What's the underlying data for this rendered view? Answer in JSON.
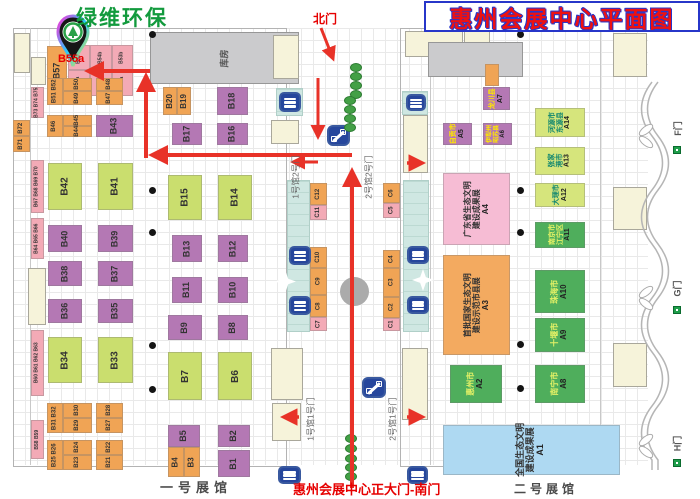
{
  "title": "惠州会展中心平面图",
  "brand": {
    "name": "绿维环保",
    "pin_label": "B55a"
  },
  "labels": {
    "north_gate": "北门",
    "south_gate": "惠州会展中心正大门-南门",
    "hall1": "一号展馆",
    "hall2": "二号展馆",
    "storage": "库房",
    "gate_f": "F门",
    "gate_g": "G门",
    "gate_h": "H门",
    "h1g2": "1号馆2号门",
    "h2g2": "2号馆2号门",
    "h1g1": "1号馆1号门",
    "h2g1": "2号馆1号门"
  },
  "colors": {
    "purple": "#b478b4",
    "lime": "#cade6e",
    "orange": "#f0a455",
    "pink": "#f3aab6",
    "pinkBig": "#f6bcd4",
    "orangeBig": "#f3aa60",
    "blue": "#aed9f2",
    "green": "#4fae5c",
    "lime2": "#d6e57c",
    "arrow": "#e83228",
    "titleRed": "#ee1111",
    "titleBlue": "#2736c9"
  },
  "booths": [
    {
      "n": "B73 B74 B75",
      "x": 31,
      "y": 87,
      "w": 13,
      "h": 31,
      "c": "pink",
      "fs": 5
    },
    {
      "n": "B67 B68 B69 B70",
      "x": 31,
      "y": 160,
      "w": 13,
      "h": 53,
      "c": "pink",
      "fs": 5
    },
    {
      "n": "B64 B65 B66",
      "x": 31,
      "y": 218,
      "w": 13,
      "h": 41,
      "c": "pink",
      "fs": 5
    },
    {
      "n": "B60 B61 B62 B63",
      "x": 31,
      "y": 330,
      "w": 13,
      "h": 66,
      "c": "pink",
      "fs": 5
    },
    {
      "n": "B58 B59",
      "x": 31,
      "y": 420,
      "w": 13,
      "h": 39,
      "c": "pink",
      "fs": 5
    },
    {
      "n": "B72",
      "x": 13,
      "y": 120,
      "w": 17,
      "h": 16,
      "c": "orange",
      "fs": 6
    },
    {
      "n": "B71",
      "x": 13,
      "y": 136,
      "w": 17,
      "h": 16,
      "c": "orange",
      "fs": 6
    },
    {
      "n": "B57",
      "x": 47,
      "y": 46,
      "w": 20,
      "h": 49,
      "c": "orange",
      "fs": 9
    },
    {
      "n": "B55b",
      "x": 68,
      "y": 45,
      "w": 22,
      "h": 25,
      "c": "pink",
      "fs": 5
    },
    {
      "n": "B55a",
      "x": 68,
      "y": 70,
      "w": 22,
      "h": 26,
      "c": "pink",
      "fs": 5
    },
    {
      "n": "B54b",
      "x": 90,
      "y": 45,
      "w": 22,
      "h": 25,
      "c": "pink",
      "fs": 5
    },
    {
      "n": "B54a",
      "x": 90,
      "y": 70,
      "w": 22,
      "h": 26,
      "c": "pink",
      "fs": 5
    },
    {
      "n": "B53b",
      "x": 112,
      "y": 45,
      "w": 21,
      "h": 25,
      "c": "pink",
      "fs": 5
    },
    {
      "n": "B53a",
      "x": 112,
      "y": 70,
      "w": 21,
      "h": 26,
      "c": "pink",
      "fs": 5
    },
    {
      "n": "B51 B52",
      "x": 47,
      "y": 78,
      "w": 16,
      "h": 27,
      "c": "orange",
      "fs": 6
    },
    {
      "n": "B50",
      "x": 63,
      "y": 78,
      "w": 29,
      "h": 13,
      "c": "orange",
      "fs": 6
    },
    {
      "n": "B49",
      "x": 63,
      "y": 91,
      "w": 29,
      "h": 14,
      "c": "orange",
      "fs": 6
    },
    {
      "n": "B48",
      "x": 96,
      "y": 78,
      "w": 27,
      "h": 13,
      "c": "orange",
      "fs": 6
    },
    {
      "n": "B47",
      "x": 96,
      "y": 91,
      "w": 27,
      "h": 14,
      "c": "orange",
      "fs": 6
    },
    {
      "n": "B46",
      "x": 47,
      "y": 115,
      "w": 16,
      "h": 22,
      "c": "orange",
      "fs": 6
    },
    {
      "n": "B45",
      "x": 63,
      "y": 115,
      "w": 29,
      "h": 11,
      "c": "orange",
      "fs": 6
    },
    {
      "n": "B44",
      "x": 63,
      "y": 126,
      "w": 29,
      "h": 11,
      "c": "orange",
      "fs": 6
    },
    {
      "n": "B43",
      "x": 96,
      "y": 115,
      "w": 37,
      "h": 22,
      "c": "purple",
      "fs": 9
    },
    {
      "n": "B42",
      "x": 48,
      "y": 163,
      "w": 34,
      "h": 47,
      "c": "lime",
      "fs": 10
    },
    {
      "n": "B41",
      "x": 98,
      "y": 163,
      "w": 35,
      "h": 47,
      "c": "lime",
      "fs": 10
    },
    {
      "n": "B40",
      "x": 48,
      "y": 225,
      "w": 34,
      "h": 27,
      "c": "purple",
      "fs": 9
    },
    {
      "n": "B39",
      "x": 98,
      "y": 225,
      "w": 35,
      "h": 27,
      "c": "purple",
      "fs": 9
    },
    {
      "n": "B38",
      "x": 48,
      "y": 261,
      "w": 34,
      "h": 25,
      "c": "purple",
      "fs": 9
    },
    {
      "n": "B37",
      "x": 98,
      "y": 261,
      "w": 35,
      "h": 25,
      "c": "purple",
      "fs": 9
    },
    {
      "n": "B36",
      "x": 48,
      "y": 299,
      "w": 34,
      "h": 24,
      "c": "purple",
      "fs": 9
    },
    {
      "n": "B35",
      "x": 98,
      "y": 299,
      "w": 35,
      "h": 24,
      "c": "purple",
      "fs": 9
    },
    {
      "n": "B34",
      "x": 48,
      "y": 337,
      "w": 34,
      "h": 46,
      "c": "lime",
      "fs": 10
    },
    {
      "n": "B33",
      "x": 98,
      "y": 337,
      "w": 35,
      "h": 46,
      "c": "lime",
      "fs": 10
    },
    {
      "n": "B31 B32",
      "x": 47,
      "y": 403,
      "w": 16,
      "h": 30,
      "c": "orange",
      "fs": 6
    },
    {
      "n": "B30",
      "x": 63,
      "y": 403,
      "w": 29,
      "h": 15,
      "c": "orange",
      "fs": 6
    },
    {
      "n": "B29",
      "x": 63,
      "y": 418,
      "w": 29,
      "h": 15,
      "c": "orange",
      "fs": 6
    },
    {
      "n": "B28",
      "x": 96,
      "y": 403,
      "w": 27,
      "h": 15,
      "c": "orange",
      "fs": 6
    },
    {
      "n": "B27",
      "x": 96,
      "y": 418,
      "w": 27,
      "h": 15,
      "c": "orange",
      "fs": 6
    },
    {
      "n": "B25 B26",
      "x": 47,
      "y": 440,
      "w": 16,
      "h": 30,
      "c": "orange",
      "fs": 6
    },
    {
      "n": "B24",
      "x": 63,
      "y": 440,
      "w": 29,
      "h": 15,
      "c": "orange",
      "fs": 6
    },
    {
      "n": "B23",
      "x": 63,
      "y": 455,
      "w": 29,
      "h": 15,
      "c": "orange",
      "fs": 6
    },
    {
      "n": "B22",
      "x": 96,
      "y": 440,
      "w": 27,
      "h": 15,
      "c": "orange",
      "fs": 6
    },
    {
      "n": "B21",
      "x": 96,
      "y": 455,
      "w": 27,
      "h": 15,
      "c": "orange",
      "fs": 6
    },
    {
      "n": "B20",
      "x": 163,
      "y": 87,
      "w": 14,
      "h": 28,
      "c": "orange",
      "fs": 8
    },
    {
      "n": "B19",
      "x": 177,
      "y": 87,
      "w": 14,
      "h": 28,
      "c": "orange",
      "fs": 8
    },
    {
      "n": "B18",
      "x": 217,
      "y": 87,
      "w": 31,
      "h": 28,
      "c": "purple",
      "fs": 9
    },
    {
      "n": "B17",
      "x": 172,
      "y": 123,
      "w": 30,
      "h": 22,
      "c": "purple",
      "fs": 9
    },
    {
      "n": "B16",
      "x": 217,
      "y": 123,
      "w": 31,
      "h": 22,
      "c": "purple",
      "fs": 9
    },
    {
      "n": "B15",
      "x": 168,
      "y": 175,
      "w": 34,
      "h": 45,
      "c": "lime",
      "fs": 10
    },
    {
      "n": "B14",
      "x": 218,
      "y": 175,
      "w": 34,
      "h": 45,
      "c": "lime",
      "fs": 10
    },
    {
      "n": "B13",
      "x": 172,
      "y": 235,
      "w": 30,
      "h": 27,
      "c": "purple",
      "fs": 9
    },
    {
      "n": "B12",
      "x": 218,
      "y": 235,
      "w": 30,
      "h": 27,
      "c": "purple",
      "fs": 9
    },
    {
      "n": "B11",
      "x": 172,
      "y": 277,
      "w": 30,
      "h": 26,
      "c": "purple",
      "fs": 9
    },
    {
      "n": "B10",
      "x": 218,
      "y": 277,
      "w": 30,
      "h": 26,
      "c": "purple",
      "fs": 9
    },
    {
      "n": "B9",
      "x": 168,
      "y": 315,
      "w": 34,
      "h": 25,
      "c": "purple",
      "fs": 9
    },
    {
      "n": "B8",
      "x": 218,
      "y": 315,
      "w": 30,
      "h": 25,
      "c": "purple",
      "fs": 9
    },
    {
      "n": "B7",
      "x": 168,
      "y": 352,
      "w": 34,
      "h": 48,
      "c": "lime",
      "fs": 10
    },
    {
      "n": "B6",
      "x": 218,
      "y": 352,
      "w": 34,
      "h": 48,
      "c": "lime",
      "fs": 10
    },
    {
      "n": "B5",
      "x": 168,
      "y": 425,
      "w": 32,
      "h": 22,
      "c": "purple",
      "fs": 9
    },
    {
      "n": "B2",
      "x": 218,
      "y": 425,
      "w": 32,
      "h": 22,
      "c": "purple",
      "fs": 9
    },
    {
      "n": "B4",
      "x": 168,
      "y": 447,
      "w": 16,
      "h": 30,
      "c": "orange",
      "fs": 8
    },
    {
      "n": "B3",
      "x": 184,
      "y": 447,
      "w": 16,
      "h": 30,
      "c": "orange",
      "fs": 8
    },
    {
      "n": "B1",
      "x": 218,
      "y": 450,
      "w": 32,
      "h": 27,
      "c": "purple",
      "fs": 9
    },
    {
      "n": "C12",
      "x": 310,
      "y": 183,
      "w": 17,
      "h": 22,
      "c": "orange",
      "fs": 6
    },
    {
      "n": "C11",
      "x": 310,
      "y": 205,
      "w": 17,
      "h": 15,
      "c": "pink",
      "fs": 6
    },
    {
      "n": "C10",
      "x": 310,
      "y": 247,
      "w": 17,
      "h": 21,
      "c": "orange",
      "fs": 6
    },
    {
      "n": "C9",
      "x": 310,
      "y": 268,
      "w": 17,
      "h": 27,
      "c": "orange",
      "fs": 6
    },
    {
      "n": "C8",
      "x": 310,
      "y": 295,
      "w": 17,
      "h": 22,
      "c": "orange",
      "fs": 6
    },
    {
      "n": "C7",
      "x": 310,
      "y": 317,
      "w": 17,
      "h": 14,
      "c": "pink",
      "fs": 6
    },
    {
      "n": "C6",
      "x": 383,
      "y": 183,
      "w": 17,
      "h": 20,
      "c": "orange",
      "fs": 6
    },
    {
      "n": "C5",
      "x": 383,
      "y": 203,
      "w": 17,
      "h": 15,
      "c": "pink",
      "fs": 6
    },
    {
      "n": "C4",
      "x": 383,
      "y": 250,
      "w": 17,
      "h": 18,
      "c": "orange",
      "fs": 6
    },
    {
      "n": "C3",
      "x": 383,
      "y": 268,
      "w": 17,
      "h": 29,
      "c": "orange",
      "fs": 6
    },
    {
      "n": "C2",
      "x": 383,
      "y": 297,
      "w": 17,
      "h": 21,
      "c": "orange",
      "fs": 6
    },
    {
      "n": "C1",
      "x": 383,
      "y": 318,
      "w": 17,
      "h": 13,
      "c": "pink",
      "fs": 6
    },
    {
      "n": "龙川县|A7",
      "x": 483,
      "y": 87,
      "w": 27,
      "h": 23,
      "c": "purple",
      "tc": "#ffe800",
      "fs": 7
    },
    {
      "n": "自贡市|A5",
      "x": 443,
      "y": 123,
      "w": 29,
      "h": 22,
      "c": "purple",
      "tc": "#ffe800",
      "fs": 7
    },
    {
      "n": "伊犁州|昭苏县|A6",
      "x": 483,
      "y": 123,
      "w": 29,
      "h": 22,
      "c": "purple",
      "tc": "#ffe800",
      "fs": 6
    },
    {
      "n": "河源市|东源县|A14",
      "x": 535,
      "y": 108,
      "w": 50,
      "h": 29,
      "c": "lime2",
      "tc": "#12876f",
      "fs": 7
    },
    {
      "n": "张家|港市|A13",
      "x": 535,
      "y": 147,
      "w": 50,
      "h": 28,
      "c": "lime2",
      "tc": "#12876f",
      "fs": 7
    },
    {
      "n": "大理市|A12",
      "x": 535,
      "y": 183,
      "w": 50,
      "h": 24,
      "c": "lime2",
      "tc": "#12876f",
      "fs": 7
    },
    {
      "n": "南京市|江宁区|A11",
      "x": 535,
      "y": 222,
      "w": 50,
      "h": 26,
      "c": "green",
      "tc": "#e4f166",
      "fs": 7
    },
    {
      "n": "珠海市|A10",
      "x": 535,
      "y": 270,
      "w": 50,
      "h": 43,
      "c": "green",
      "tc": "#e4f166",
      "fs": 8
    },
    {
      "n": "十堰市|A9",
      "x": 535,
      "y": 318,
      "w": 50,
      "h": 34,
      "c": "green",
      "tc": "#e4f166",
      "fs": 8
    },
    {
      "n": "广东省生态文明|建设成果展|A4",
      "x": 443,
      "y": 173,
      "w": 67,
      "h": 72,
      "c": "pinkBig",
      "tc": "#333333",
      "fs": 8
    },
    {
      "n": "首批国家生态文明|建设示范市县展|A3",
      "x": 443,
      "y": 255,
      "w": 67,
      "h": 100,
      "c": "orangeBig",
      "tc": "#333333",
      "fs": 8
    },
    {
      "n": "惠州市|A2",
      "x": 450,
      "y": 365,
      "w": 52,
      "h": 38,
      "c": "green",
      "tc": "#e4f166",
      "fs": 8
    },
    {
      "n": "南宁市|A8",
      "x": 535,
      "y": 365,
      "w": 50,
      "h": 38,
      "c": "green",
      "tc": "#e4f166",
      "fs": 8
    },
    {
      "n": "全国生态文明|建设成果展|A1",
      "x": 443,
      "y": 425,
      "w": 177,
      "h": 50,
      "c": "blue",
      "tc": "#333333",
      "fs": 9
    },
    {
      "n": "",
      "x": 485,
      "y": 64,
      "w": 14,
      "h": 22,
      "c": "orange",
      "fs": 5
    }
  ],
  "buildings": [
    {
      "x": 150,
      "y": 32,
      "w": 149,
      "h": 52,
      "t": "gray",
      "label": "库房"
    },
    {
      "x": 273,
      "y": 35,
      "w": 26,
      "h": 44,
      "t": "cream"
    },
    {
      "x": 14,
      "y": 33,
      "w": 16,
      "h": 40,
      "t": "cream"
    },
    {
      "x": 31,
      "y": 57,
      "w": 15,
      "h": 28,
      "t": "cream"
    },
    {
      "x": 28,
      "y": 268,
      "w": 18,
      "h": 57,
      "t": "cream"
    },
    {
      "x": 276,
      "y": 88,
      "w": 27,
      "h": 28,
      "t": "teal"
    },
    {
      "x": 402,
      "y": 91,
      "w": 26,
      "h": 24,
      "t": "teal"
    },
    {
      "x": 287,
      "y": 180,
      "w": 23,
      "h": 152,
      "t": "teal"
    },
    {
      "x": 403,
      "y": 180,
      "w": 26,
      "h": 152,
      "t": "teal"
    },
    {
      "x": 271,
      "y": 120,
      "w": 28,
      "h": 24,
      "t": "cream"
    },
    {
      "x": 271,
      "y": 348,
      "w": 32,
      "h": 52,
      "t": "cream"
    },
    {
      "x": 272,
      "y": 403,
      "w": 29,
      "h": 38,
      "t": "cream"
    },
    {
      "x": 405,
      "y": 31,
      "w": 58,
      "h": 26,
      "t": "cream"
    },
    {
      "x": 464,
      "y": 31,
      "w": 26,
      "h": 25,
      "t": "cream"
    },
    {
      "x": 428,
      "y": 42,
      "w": 95,
      "h": 35,
      "t": "gray"
    },
    {
      "x": 403,
      "y": 115,
      "w": 25,
      "h": 58,
      "t": "cream"
    },
    {
      "x": 402,
      "y": 348,
      "w": 26,
      "h": 72,
      "t": "cream"
    },
    {
      "x": 613,
      "y": 33,
      "w": 34,
      "h": 44,
      "t": "cream"
    },
    {
      "x": 613,
      "y": 187,
      "w": 34,
      "h": 43,
      "t": "cream"
    },
    {
      "x": 613,
      "y": 343,
      "w": 34,
      "h": 44,
      "t": "cream"
    }
  ],
  "icons": {
    "escalators": [
      {
        "type": "bars",
        "x": 279,
        "y": 92,
        "w": 22,
        "h": 20
      },
      {
        "type": "bars",
        "x": 289,
        "y": 246,
        "w": 22,
        "h": 19
      },
      {
        "type": "bars",
        "x": 289,
        "y": 296,
        "w": 22,
        "h": 19
      },
      {
        "type": "bars",
        "x": 278,
        "y": 466,
        "w": 23,
        "h": 18
      },
      {
        "type": "bars",
        "x": 406,
        "y": 94,
        "w": 20,
        "h": 17
      },
      {
        "type": "bars",
        "x": 407,
        "y": 246,
        "w": 22,
        "h": 18
      },
      {
        "type": "bars",
        "x": 407,
        "y": 296,
        "w": 22,
        "h": 18
      },
      {
        "type": "bars",
        "x": 407,
        "y": 466,
        "w": 21,
        "h": 18
      },
      {
        "type": "diag",
        "x": 327,
        "y": 125,
        "w": 23,
        "h": 21
      },
      {
        "type": "diag",
        "x": 362,
        "y": 377,
        "w": 24,
        "h": 21
      }
    ],
    "stars": [
      {
        "x": 275,
        "y": 271,
        "s": 21
      },
      {
        "x": 412,
        "y": 269,
        "s": 22
      }
    ],
    "pillars": [
      [
        152,
        34
      ],
      [
        152,
        190
      ],
      [
        152,
        232
      ],
      [
        152,
        345
      ],
      [
        152,
        389
      ],
      [
        520,
        34
      ],
      [
        520,
        190
      ],
      [
        520,
        232
      ],
      [
        520,
        344
      ],
      [
        520,
        388
      ]
    ],
    "trees": [
      [
        355,
        67
      ],
      [
        355,
        76
      ],
      [
        355,
        85
      ],
      [
        355,
        94
      ],
      [
        349,
        100
      ],
      [
        349,
        109
      ],
      [
        349,
        118
      ],
      [
        349,
        127
      ],
      [
        350,
        438
      ],
      [
        350,
        448
      ],
      [
        350,
        458
      ],
      [
        350,
        467
      ],
      [
        350,
        476
      ]
    ],
    "fountain": {
      "x": 340,
      "y": 277,
      "d": 29
    }
  },
  "arrows": [
    {
      "x1": 150,
      "y1": 71,
      "x2": 92,
      "y2": 71,
      "w": 4
    },
    {
      "x1": 146,
      "y1": 158,
      "x2": 146,
      "y2": 80,
      "w": 4
    },
    {
      "x1": 352,
      "y1": 155,
      "x2": 156,
      "y2": 155,
      "w": 4
    },
    {
      "x1": 318,
      "y1": 162,
      "x2": 296,
      "y2": 162,
      "w": 3
    },
    {
      "x1": 352,
      "y1": 488,
      "x2": 352,
      "y2": 175,
      "w": 4
    },
    {
      "x1": 321,
      "y1": 28,
      "x2": 332,
      "y2": 56,
      "w": 3
    },
    {
      "x1": 318,
      "y1": 78,
      "x2": 318,
      "y2": 134,
      "w": 3
    },
    {
      "x1": 299,
      "y1": 417,
      "x2": 287,
      "y2": 417,
      "w": 3.5
    },
    {
      "x1": 407,
      "y1": 417,
      "x2": 419,
      "y2": 417,
      "w": 3.5
    },
    {
      "x1": 407,
      "y1": 163,
      "x2": 419,
      "y2": 163,
      "w": 3.5
    }
  ]
}
